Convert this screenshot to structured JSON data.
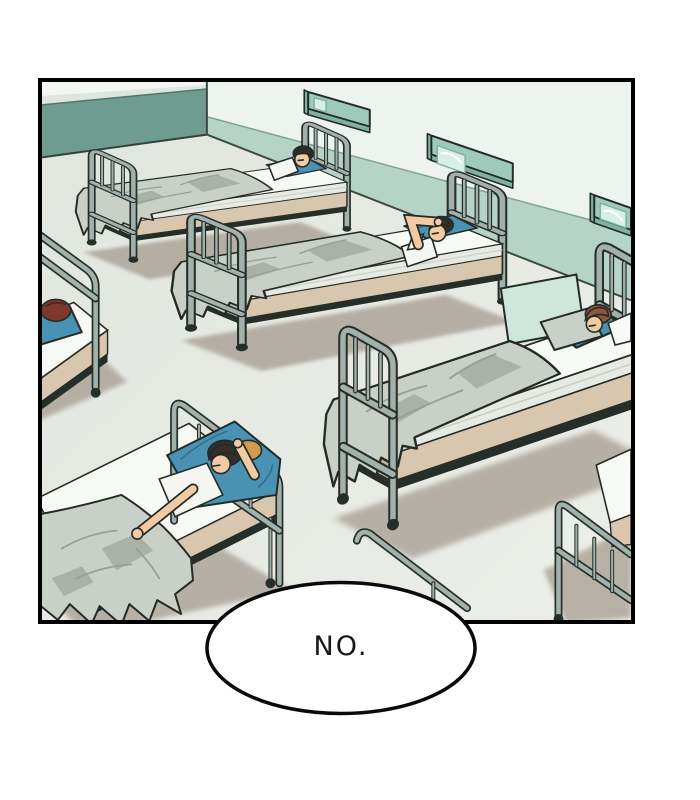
{
  "speech_bubble": {
    "text": "NO."
  },
  "panel": {
    "description": "Hospital dormitory ward drawn in comic style; rows of metal-framed beds with sleeping patients under gray blankets on teal pillows; teal wall-mounted light fixtures on the right wall."
  },
  "palette": {
    "paper": "#ffffff",
    "ink": "#000000",
    "outline": "#242b26",
    "wall_upper_left": "#dde7e0",
    "wall_upper_right": "#edf3ef",
    "wall_sliver": "#f3f6f2",
    "wall_band_left": "#6f9c90",
    "wall_band_right": "#b5d3c6",
    "floor": "#ecefe9",
    "floor_edge": "#e0e5de",
    "floor_shadow": "#a1968a",
    "fixture": "#9ecabc",
    "fixture_dark": "#7fb0a2",
    "fixture_light": "#d8efe7",
    "metal": "#a3b1ad",
    "metal_dark": "#262e29",
    "mattress": "#f7f9f4",
    "mattress_side": "#e6eae2",
    "base_tan": "#d9c6ae",
    "base_tan_dark": "#c6b298",
    "blanket": "#c9d0c8",
    "blanket_shadow": "#97a198",
    "pillow": "#4a92b4",
    "pillow_dark": "#2f6f90",
    "skin": "#f2cba4",
    "shirt": "#f5f6f1",
    "hair_black": "#332f2b",
    "hair_brown": "#8a5738",
    "hair_auburn": "#7c392c",
    "hair_blonde": "#d09c4f",
    "glass_panel": "#cfe6dc"
  },
  "scene": {
    "wall_fixtures": [
      {
        "id": "wall-light-1",
        "position": "upper-left of right wall"
      },
      {
        "id": "wall-light-2",
        "position": "middle of right wall"
      },
      {
        "id": "wall-light-3",
        "position": "far right, cut by panel edge"
      }
    ],
    "beds": [
      {
        "id": "bed-back-left",
        "person": {
          "hair": "black",
          "pose": "asleep on back"
        }
      },
      {
        "id": "bed-middle",
        "person": {
          "hair": "black",
          "pose": "asleep, arm over forehead"
        }
      },
      {
        "id": "bed-right",
        "person": {
          "hair": "brown",
          "pose": "asleep on side"
        }
      },
      {
        "id": "bed-foreground",
        "person": {
          "hair": "black and blonde",
          "pose": "asleep, arm across bed"
        }
      },
      {
        "id": "bed-left-edge",
        "person": {
          "hair": "auburn",
          "pose": "facing away"
        }
      },
      {
        "id": "bed-bottom-right",
        "person": null
      }
    ]
  }
}
